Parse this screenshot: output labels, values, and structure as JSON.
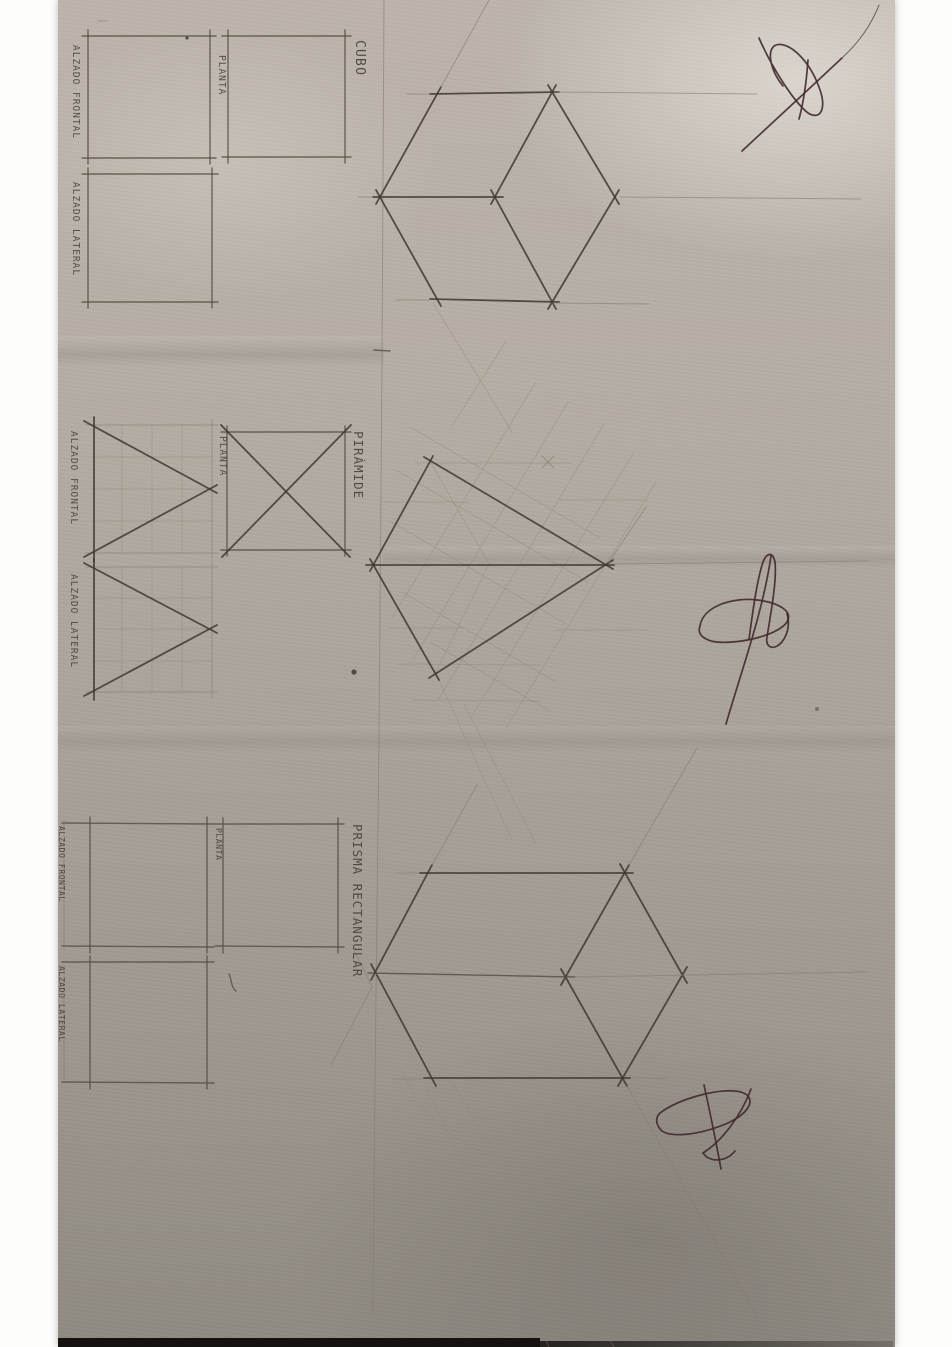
{
  "colors": {
    "background": "#fdfdfc",
    "paper_light": "#bdb5ab",
    "paper_dark": "#8f8a82",
    "pencil_dark": "#3f382f",
    "pencil_faint": "#8f8678",
    "pen_ink": "#41282c",
    "bottom_edge": "#15120f"
  },
  "sections": {
    "cube": {
      "title": "CUBO",
      "views": {
        "front_label": "ALZADO FRONTAL",
        "plan_label": "PLANTA",
        "side_label": "ALZADO LATERAL"
      }
    },
    "pyramid": {
      "title": "PIRÁMIDE",
      "views": {
        "front_label": "ALZADO FRONTAL",
        "plan_label": "PLANTA",
        "side_label": "ALZADO LATERAL"
      }
    },
    "prism": {
      "title": "PRISMA RECTANGULAR",
      "views": {
        "front_label": "ALZADO FRONTAL",
        "plan_label": "PLANTA",
        "side_label": "ALZADO LATERAL"
      }
    }
  }
}
